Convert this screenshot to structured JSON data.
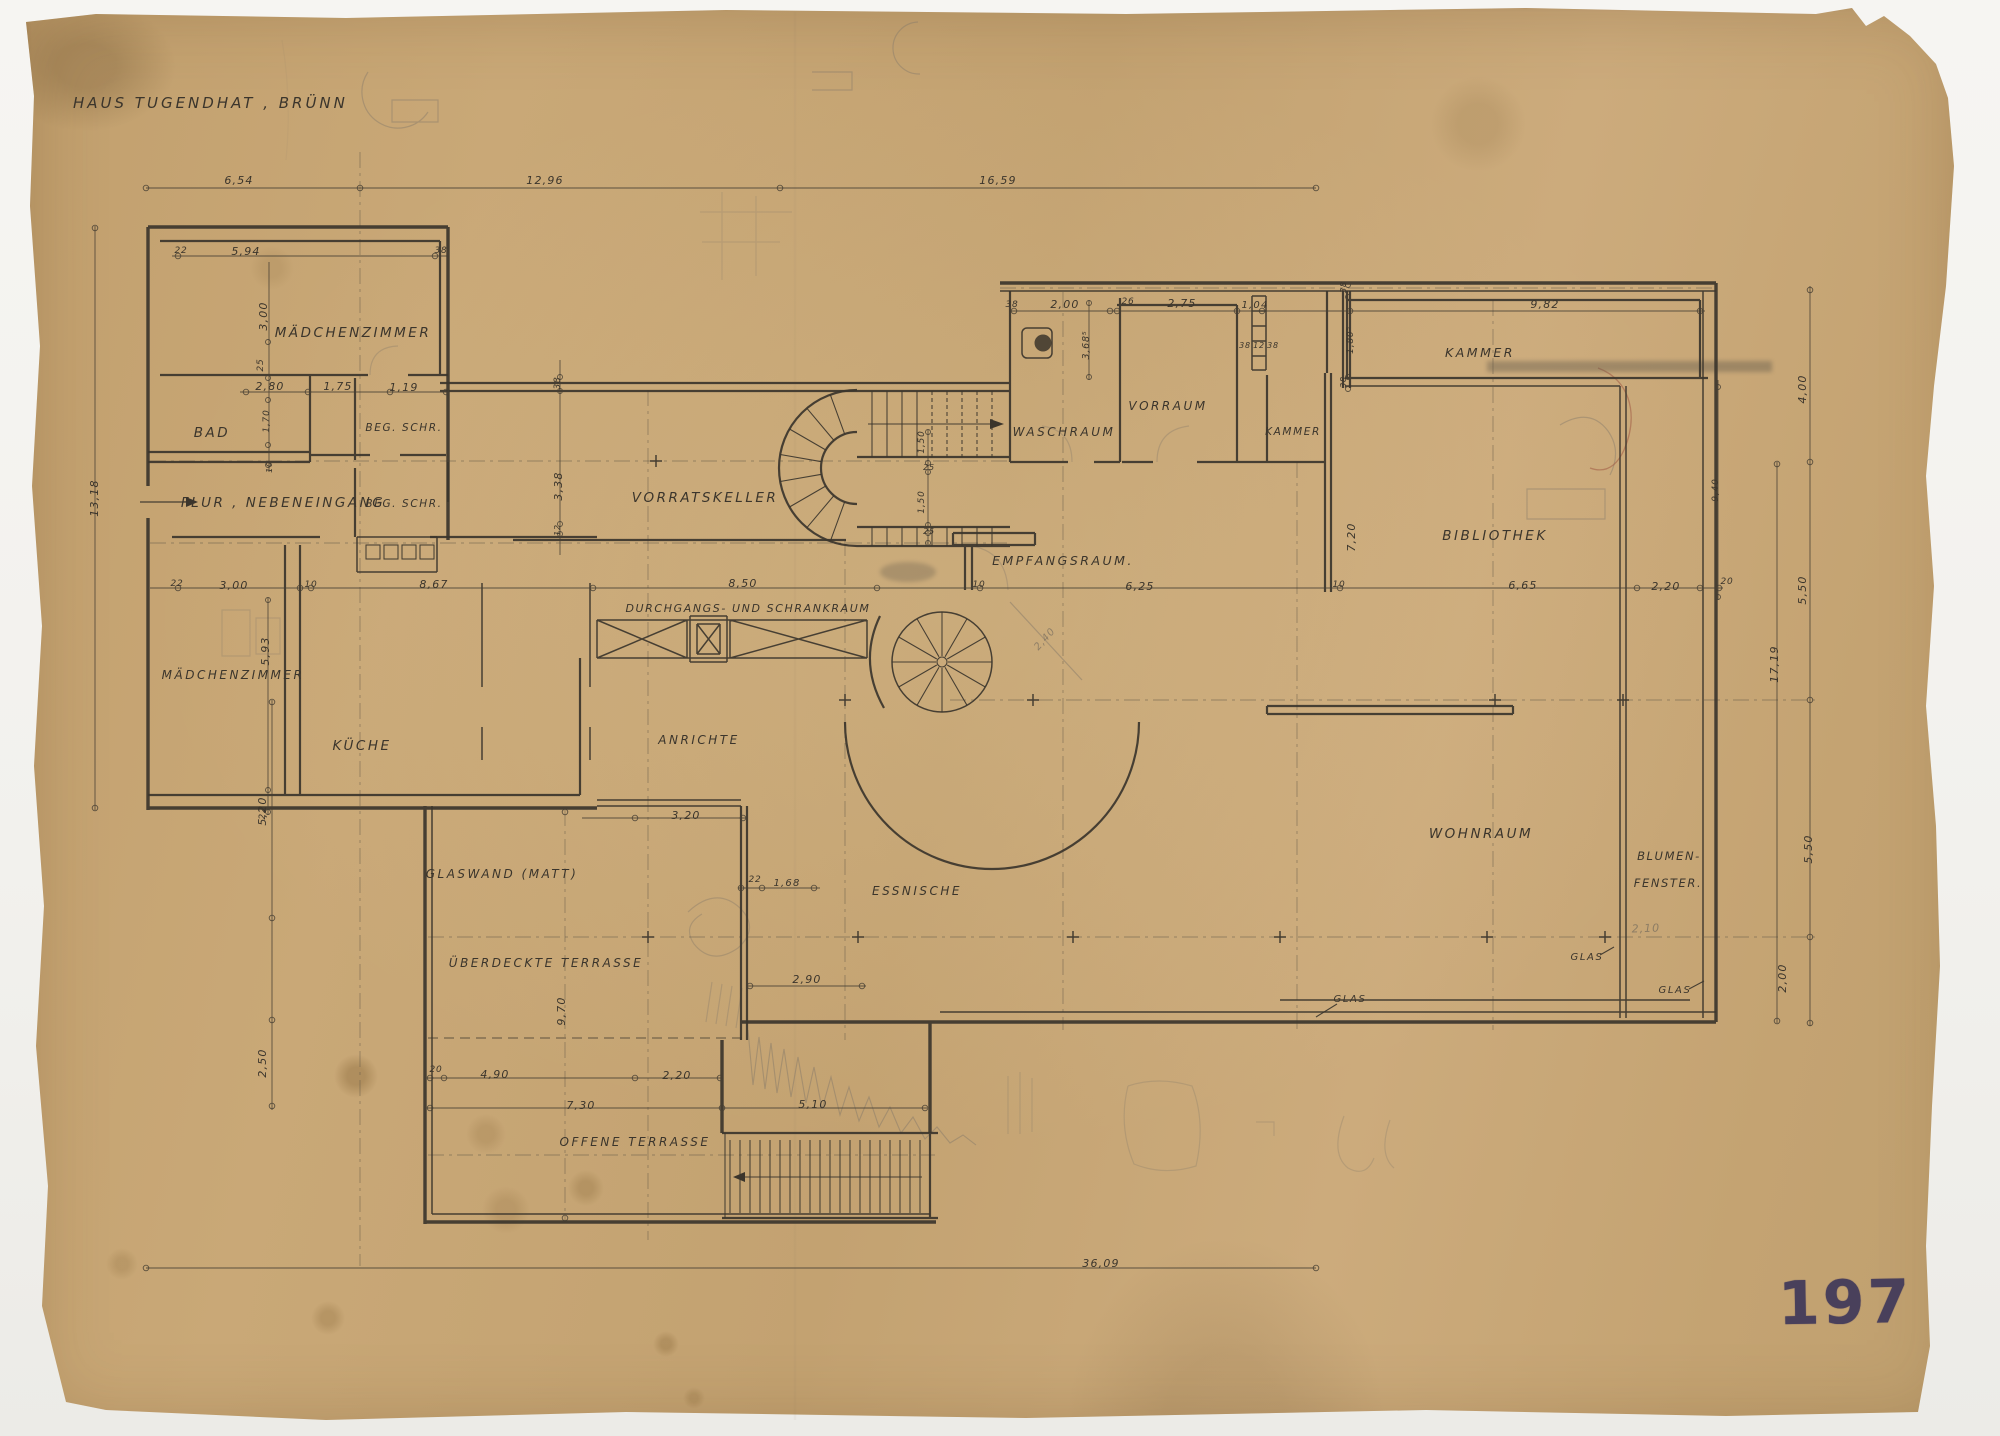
{
  "labels": {
    "title": "HAUS TUGENDHAT , BRÜNN",
    "stamp": "197"
  },
  "rooms": {
    "maedchenzimmer_top": "MÄDCHENZIMMER",
    "bad": "BAD",
    "beg_schr_1": "BEG. SCHR.",
    "flur_nebeneingang": "FLUR , NEBENEINGANG",
    "beg_schr_2": "BEG. SCHR.",
    "vorratskeller": "VORRATSKELLER",
    "maedchenzimmer_unten": "MÄDCHENZIMMER",
    "kueche": "KÜCHE",
    "durchgangs_schrankraum": "DURCHGANGS- UND SCHRANKRAUM",
    "anrichte": "ANRICHTE",
    "empfangsraum": "EMPFANGSRAUM.",
    "waschraum": "WASCHRAUM",
    "vorraum": "VORRAUM",
    "kammer_klein": "KAMMER",
    "kammer_lang": "KAMMER",
    "bibliothek": "BIBLIOTHEK",
    "wohnraum": "WOHNRAUM",
    "blumen": "BLUMEN-",
    "fenster": "FENSTER.",
    "glaswand_matt": "GLASWAND (MATT)",
    "ueberdeckte_terrasse": "ÜBERDECKTE TERRASSE",
    "offene_terrasse": "OFFENE TERRASSE",
    "essnische": "ESSNISCHE",
    "glas_a": "GLAS",
    "glas_b": "GLAS",
    "glas_c": "GLAS"
  },
  "dims": {
    "t654": "6,54",
    "t1296": "12,96",
    "t1659": "16,59",
    "a22": "22",
    "a594": "5,94",
    "a38": "38",
    "b300": "3,00",
    "b25": "25",
    "b280": "2,80",
    "b175": "1,75",
    "b119": "1,19",
    "b170": "1,70",
    "b10": "10",
    "c22": "22",
    "c300": "3,00",
    "c10": "10",
    "c867": "8,67",
    "c850": "8,50",
    "c625": "6,25",
    "c10b": "10",
    "c10c": "10",
    "c665": "6,65",
    "c220": "2,20",
    "c20": "20",
    "d593": "5,93",
    "d22": "22",
    "e38": "38",
    "e338": "3,38",
    "e12": "12",
    "f150a": "1,50",
    "f25a": "25",
    "f150b": "1,50",
    "f25b": "25",
    "g38": "38",
    "g200": "2,00",
    "g368": "3,68⁵",
    "h26": "26",
    "h275": "2,75",
    "h104": "1,04",
    "h38a": "38",
    "h12": "12",
    "h38b": "38",
    "i38a": "38",
    "i180": "1,80⁵",
    "i38b": "38",
    "i982": "9,82",
    "j720": "7,20",
    "j940": "9,40",
    "k1318": "13,18",
    "k520": "5,20",
    "k250": "2,50",
    "l320": "3,20",
    "l22": "22",
    "l168": "1,68",
    "l290": "2,90",
    "l970": "9,70",
    "m20": "20",
    "m490": "4,90",
    "m220": "2,20",
    "m730": "7,30",
    "m510": "5,10",
    "m3609": "36,09",
    "n400": "4,00",
    "n550a": "5,50",
    "n1719": "17,19",
    "n550b": "5,50",
    "n200": "2,00"
  },
  "pencil": {
    "p210": "2,10",
    "p240": "2,40"
  },
  "colors": {
    "paper": "#c8a776",
    "ink": "#3b352c",
    "pencil": "#85796a",
    "stamp": "#433b5a",
    "scan_bg": "#f6f5f2"
  }
}
